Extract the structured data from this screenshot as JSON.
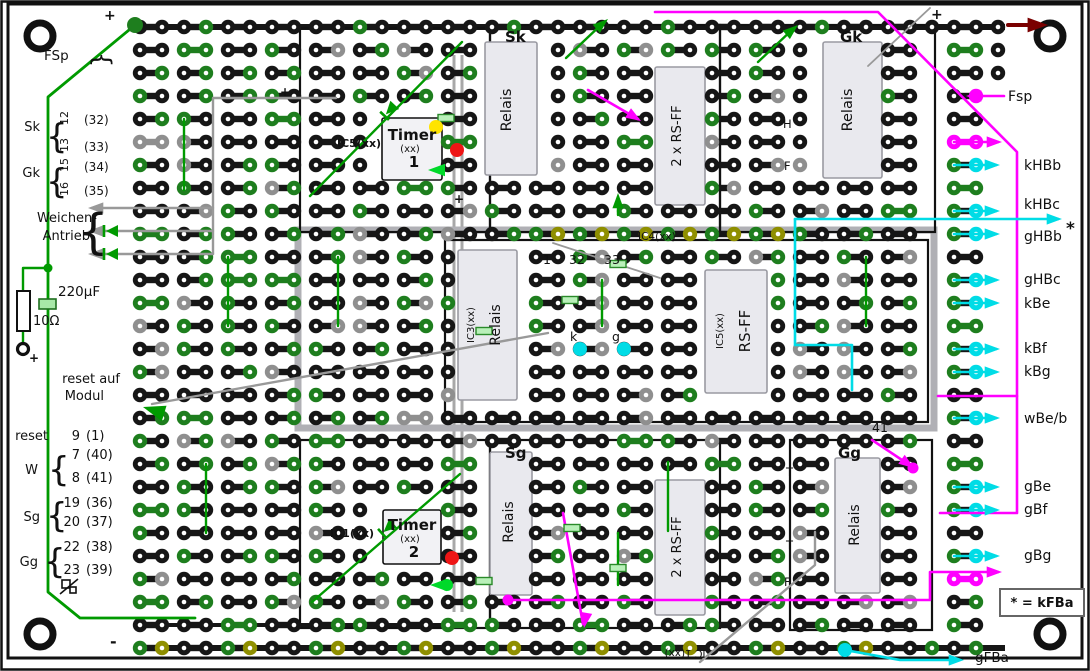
{
  "colors": {
    "wire_green": "#009a00",
    "bright_green": "#00d92a",
    "wire_gray": "#999999",
    "wire_magenta": "#ff00ff",
    "wire_cyan": "#00dce6",
    "dark_red": "#7a0000",
    "dot_black": "#161616",
    "dot_gray": "#8f8f8f",
    "dot_green": "#1e7e1e",
    "dot_olive": "#8f8f00",
    "led_yellow": "#ffe400",
    "led_red": "#ee1515",
    "component_fill": "#e9e9ee",
    "component_border": "#9a9aa2"
  },
  "left": {
    "fsp": "FSp",
    "sk": {
      "label": "Sk",
      "pins": [
        {
          "pin": "12",
          "alt": "(32)"
        },
        {
          "pin": "13",
          "alt": "(33)"
        }
      ]
    },
    "gk": {
      "label": "Gk",
      "pins": [
        {
          "pin": "15",
          "alt": "(34)"
        },
        {
          "pin": "16",
          "alt": "(35)"
        }
      ]
    },
    "weichen_line1": "Weichen-",
    "weichen_line2": "Antrieb",
    "capacitor": "220µF",
    "resistor": "10Ω",
    "reset_note_line1": "reset auf",
    "reset_note_line2": "Modul",
    "reset": {
      "label": "reset",
      "pin": "9",
      "alt": "(1)"
    },
    "w": {
      "label": "W",
      "pins": [
        {
          "pin": "7",
          "alt": "(40)"
        },
        {
          "pin": "8",
          "alt": "(41)"
        }
      ]
    },
    "sg": {
      "label": "Sg",
      "pins": [
        {
          "pin": "19",
          "alt": "(36)"
        },
        {
          "pin": "20",
          "alt": "(37)"
        }
      ]
    },
    "gg": {
      "label": "Gg",
      "pins": [
        {
          "pin": "22",
          "alt": "(38)"
        },
        {
          "pin": "23",
          "alt": "(39)"
        }
      ]
    }
  },
  "right": {
    "fsp": "Fsp",
    "signals": [
      "kHBb",
      "kHBc",
      "gHBb",
      "gHBc",
      "kBe",
      "kBf",
      "kBg",
      "wBe/b",
      "gBe",
      "gBf",
      "gBg"
    ],
    "star": "*",
    "legend": "* = kFBa",
    "gfba": "gFBa"
  },
  "modules": {
    "sk": "Sk",
    "gk": "Gk",
    "sg": "Sg",
    "gg": "Gg"
  },
  "components": {
    "relais": "Relais",
    "rsff_dual": "2 x RS-FF",
    "rsff": "RS-FF",
    "timer1": {
      "name": "Timer",
      "part": "(xx)",
      "number": "1",
      "ic": "IC5(xx)"
    },
    "timer2": {
      "name": "Timer",
      "part": "(xx)",
      "number": "2",
      "ic": "IC1(xx)"
    },
    "ic3": "IC3(xx)",
    "ic4": "IC4(xx)",
    "ic5": "IC5(xx)",
    "ic_bottom": "IC 1(xx)"
  },
  "annotations": {
    "numbers": {
      "one": "1",
      "thirty_two": "32",
      "thirty_three": "33",
      "forty_one": "41"
    },
    "k": "k",
    "g": "g",
    "letters": [
      "H",
      "F",
      "T",
      "T",
      "F"
    ],
    "plus": "+",
    "minus": "-"
  }
}
